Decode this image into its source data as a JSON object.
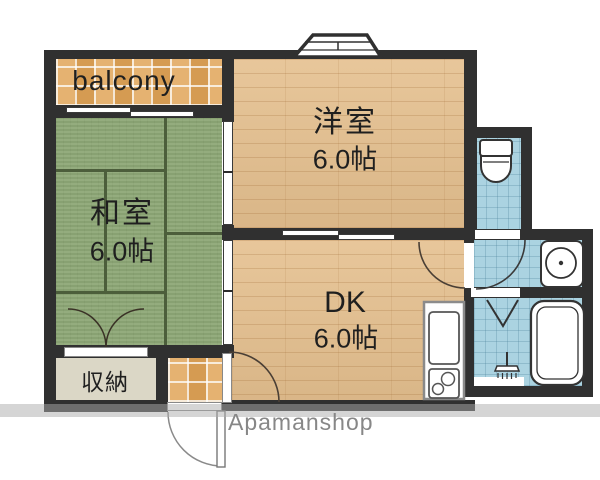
{
  "watermark": {
    "text": "Apamanshop"
  },
  "rooms": {
    "balcony": {
      "label": "balcony"
    },
    "japanese_room": {
      "label": "和室",
      "size": "6.0帖"
    },
    "western_room": {
      "label": "洋室",
      "size": "6.0帖"
    },
    "dining_kitchen": {
      "label": "DK",
      "size": "6.0帖"
    },
    "storage": {
      "label": "収納"
    }
  },
  "icons": {
    "toilet": "toilet-icon",
    "wash_basin": "wash-basin-icon",
    "bathtub": "bathtub-icon",
    "shower": "shower-icon",
    "kitchen_sink": "kitchen-sink-icon",
    "stove": "stove-burners-icon",
    "bay_window": "bay-window-icon"
  },
  "colors": {
    "wall": "#303030",
    "tatami": "#8ea877",
    "wood": "#e5c08f",
    "tile_orange": "#e0a356",
    "tile_blue": "#abd3e1",
    "storage_floor": "#dbd7c6",
    "watermark_text": "#878787"
  }
}
